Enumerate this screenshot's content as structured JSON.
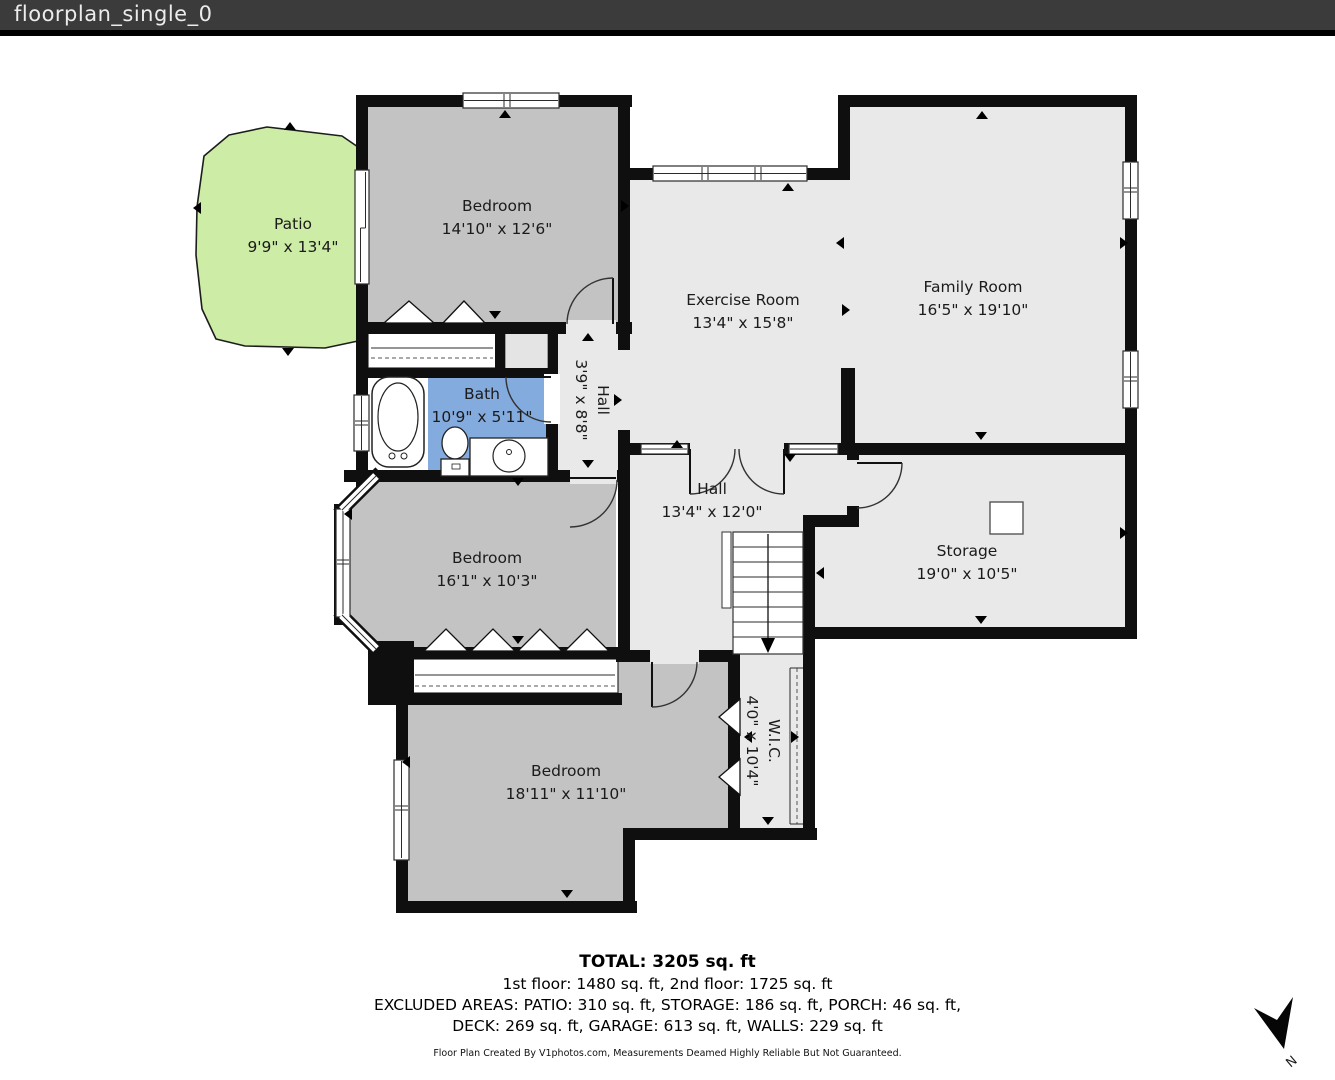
{
  "header": {
    "title": "floorplan_single_0"
  },
  "rooms": {
    "patio": {
      "name": "Patio",
      "dims": "9'9\" x 13'4\""
    },
    "bedroom_top": {
      "name": "Bedroom",
      "dims": "14'10\" x 12'6\""
    },
    "exercise": {
      "name": "Exercise Room",
      "dims": "13'4\" x 15'8\""
    },
    "family": {
      "name": "Family Room",
      "dims": "16'5\" x 19'10\""
    },
    "bath": {
      "name": "Bath",
      "dims": "10'9\" x 5'11\""
    },
    "hall_small": {
      "name": "Hall",
      "dims": "3'9\" x 8'8\""
    },
    "hall_main": {
      "name": "Hall",
      "dims": "13'4\" x 12'0\""
    },
    "storage": {
      "name": "Storage",
      "dims": "19'0\" x 10'5\""
    },
    "bedroom_mid": {
      "name": "Bedroom",
      "dims": "16'1\" x 10'3\""
    },
    "bedroom_bottom": {
      "name": "Bedroom",
      "dims": "18'11\" x 11'10\""
    },
    "wic": {
      "name": "W.I.C.",
      "dims": "4'0\" x 10'4\""
    }
  },
  "footer": {
    "total": "TOTAL: 3205 sq. ft",
    "floors": "1st floor: 1480 sq. ft, 2nd floor: 1725 sq. ft",
    "excluded_line1": "EXCLUDED AREAS: PATIO: 310 sq. ft, STORAGE: 186 sq. ft, PORCH: 46 sq. ft,",
    "excluded_line2": "DECK: 269 sq. ft, GARAGE: 613 sq. ft, WALLS: 229 sq. ft",
    "credit": "Floor Plan Created By V1photos.com, Measurements Deamed Highly Reliable But Not Guaranteed."
  },
  "compass": {
    "label": "N"
  },
  "colors": {
    "header_bg": "#3b3b3b",
    "wall": "#0f0f0f",
    "patio_green": "#cdeca5",
    "bedroom_gray": "#c3c3c3",
    "room_light_gray": "#e9e9e9",
    "bath_blue": "#84abde"
  }
}
